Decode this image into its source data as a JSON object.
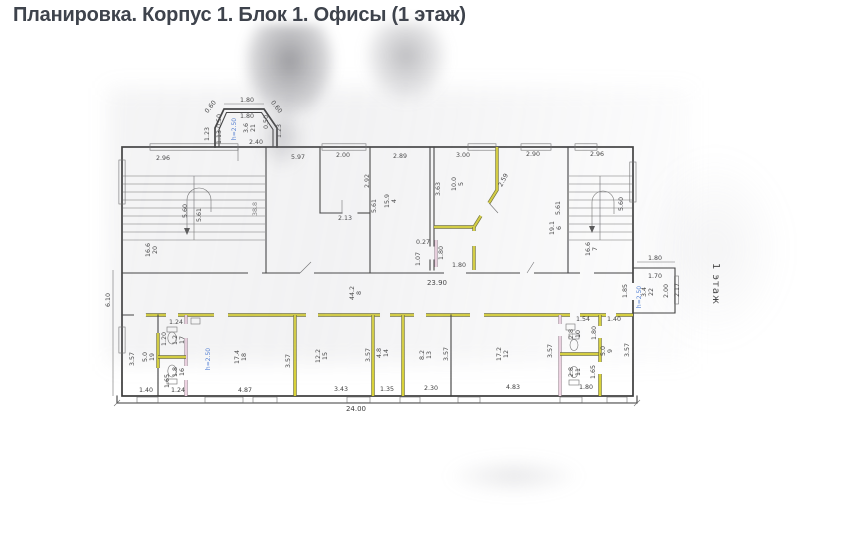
{
  "header": {
    "title": "Планировка. Корпус 1. Блок 1. Офисы (1 этаж)"
  },
  "plan": {
    "floor_label": "1 этаж",
    "colors": {
      "wall_line": "#3b3b3b",
      "highlight_yellow": "#d8d139",
      "highlight_pink": "#eed3e2",
      "height_note_blue": "#4f7fd9",
      "title_text": "#3e434c"
    },
    "heights": {
      "bay": "h=2.50",
      "office_18": "h=2.50",
      "annex": "h=2.50"
    },
    "rooms": {
      "open_office": {
        "number": "",
        "area": "38.8"
      },
      "r4": {
        "number": "4",
        "area": "15.9"
      },
      "r5": {
        "number": "5",
        "area": "10.0"
      },
      "r6": {
        "number": "6",
        "area": "19.1"
      },
      "r7": {
        "number": "7",
        "area": "16.6"
      },
      "r8": {
        "number": "8",
        "area": "44.2"
      },
      "r9": {
        "number": "9",
        "area": "5.0"
      },
      "r10": {
        "number": "10",
        "area": "2.8"
      },
      "r11": {
        "number": "11",
        "area": "2.8"
      },
      "r12": {
        "number": "12",
        "area": "17.2"
      },
      "r13": {
        "number": "13",
        "area": "8.2"
      },
      "r14": {
        "number": "14",
        "area": "4.8"
      },
      "r15": {
        "number": "15",
        "area": "12.2"
      },
      "r16": {
        "number": "16",
        "area": "1.8"
      },
      "r17": {
        "number": "17",
        "area": "1.2"
      },
      "r18": {
        "number": "18",
        "area": "17.4"
      },
      "r19": {
        "number": "19",
        "area": "5.0"
      },
      "r20": {
        "number": "20",
        "area": "16.6"
      },
      "r21": {
        "number": "21",
        "area": "3.6"
      },
      "r22": {
        "number": "22",
        "area": "3.4"
      }
    },
    "dims": {
      "top": [
        "2.96",
        "5.97",
        "2.00",
        "2.89",
        "3.00",
        "2.90",
        "2.96"
      ],
      "bay": [
        "1.80",
        "1.80",
        "0.60",
        "1.23",
        "0.50",
        "1.13",
        "0.60",
        "0.50",
        "1.23",
        "2.40"
      ],
      "left": [
        "6.10"
      ],
      "stair_left": [
        "5.60",
        "5.61"
      ],
      "inner_top": [
        "2.92",
        "2.13",
        "5.61",
        "3.63",
        "2.59",
        "0.27",
        "1.07",
        "1.80",
        "1.80"
      ],
      "stair_right": [
        "5.61",
        "5.60"
      ],
      "corridor": [
        "23.90",
        "1.85"
      ],
      "annex": [
        "1.80",
        "1.70",
        "2.00",
        "2.17"
      ],
      "bottom_edge": [
        "1.40",
        "1.24",
        "4.87",
        "3.43",
        "1.35",
        "2.30",
        "4.83",
        "1.80",
        "24.00"
      ],
      "bottom_inner": [
        "3.57",
        "1.24",
        "1.20",
        "1.65",
        "3.57",
        "3.57",
        "3.57",
        "3.57",
        "1.54",
        "1.40",
        "1.80",
        "1.65",
        "3.57"
      ]
    }
  }
}
